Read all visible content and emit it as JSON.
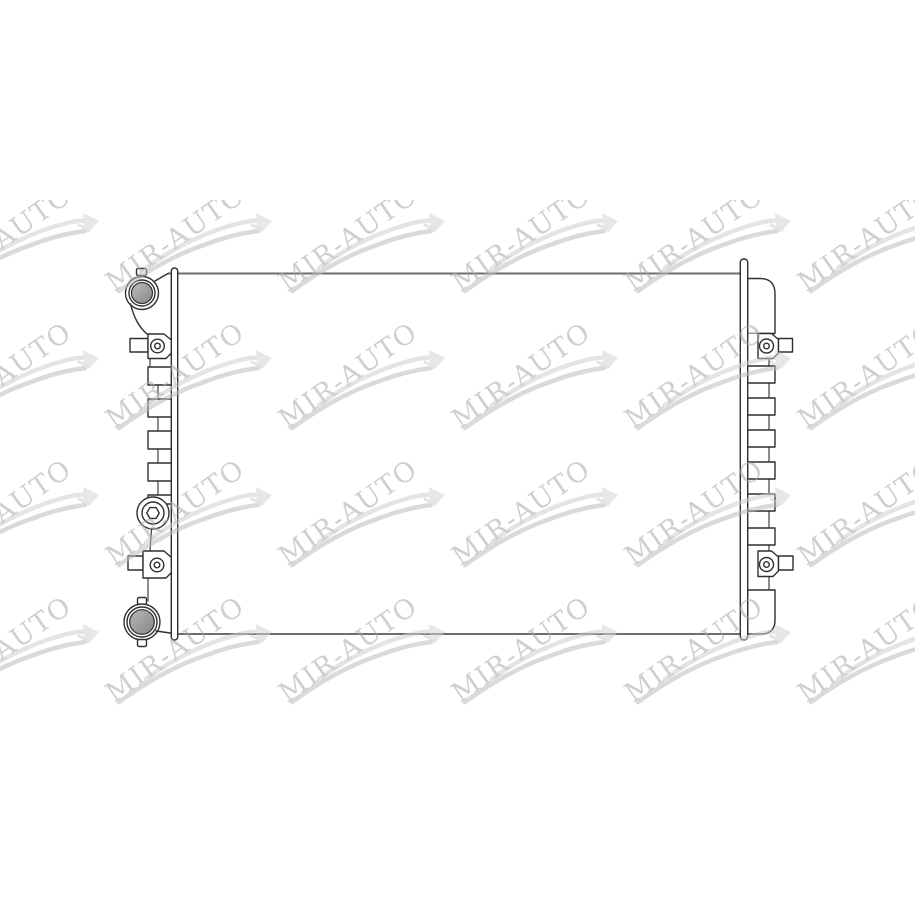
{
  "image": {
    "background_color": "#ffffff",
    "subject": "automotive radiator technical line drawing",
    "photo_area": {
      "left": 0,
      "top": 200,
      "width": 915,
      "height": 517
    }
  },
  "watermark": {
    "text": "MIR-AUTO",
    "rotation_deg": -35,
    "font_size_px": 27,
    "opacity": 0.55,
    "grid": {
      "cols": 6,
      "rows": 4,
      "col_start": -57,
      "row_start": 15,
      "col_step": 173,
      "row_step": 137
    },
    "colors": {
      "text": "#a9a9a9",
      "swoosh_main": "#bdbdbd",
      "swoosh_upper": "#cfcfcf",
      "flag": "#d4d4d4"
    }
  },
  "drawing": {
    "colors": {
      "outline": "#2f2f2f",
      "long_edge": "#6e6e6e",
      "metal_light": "#bcbcbc",
      "metal_dark": "#878787"
    },
    "parts": [
      "filler-cap",
      "left-header-plate",
      "radiator-core",
      "side-ribs-left",
      "drain-plug",
      "outlet-port",
      "mounting-bracket-top-left",
      "mounting-bracket-bottom-left",
      "right-end-tank",
      "side-ribs-right",
      "mounting-bracket-top-right",
      "mounting-bracket-bottom-right",
      "right-header-plate"
    ]
  }
}
